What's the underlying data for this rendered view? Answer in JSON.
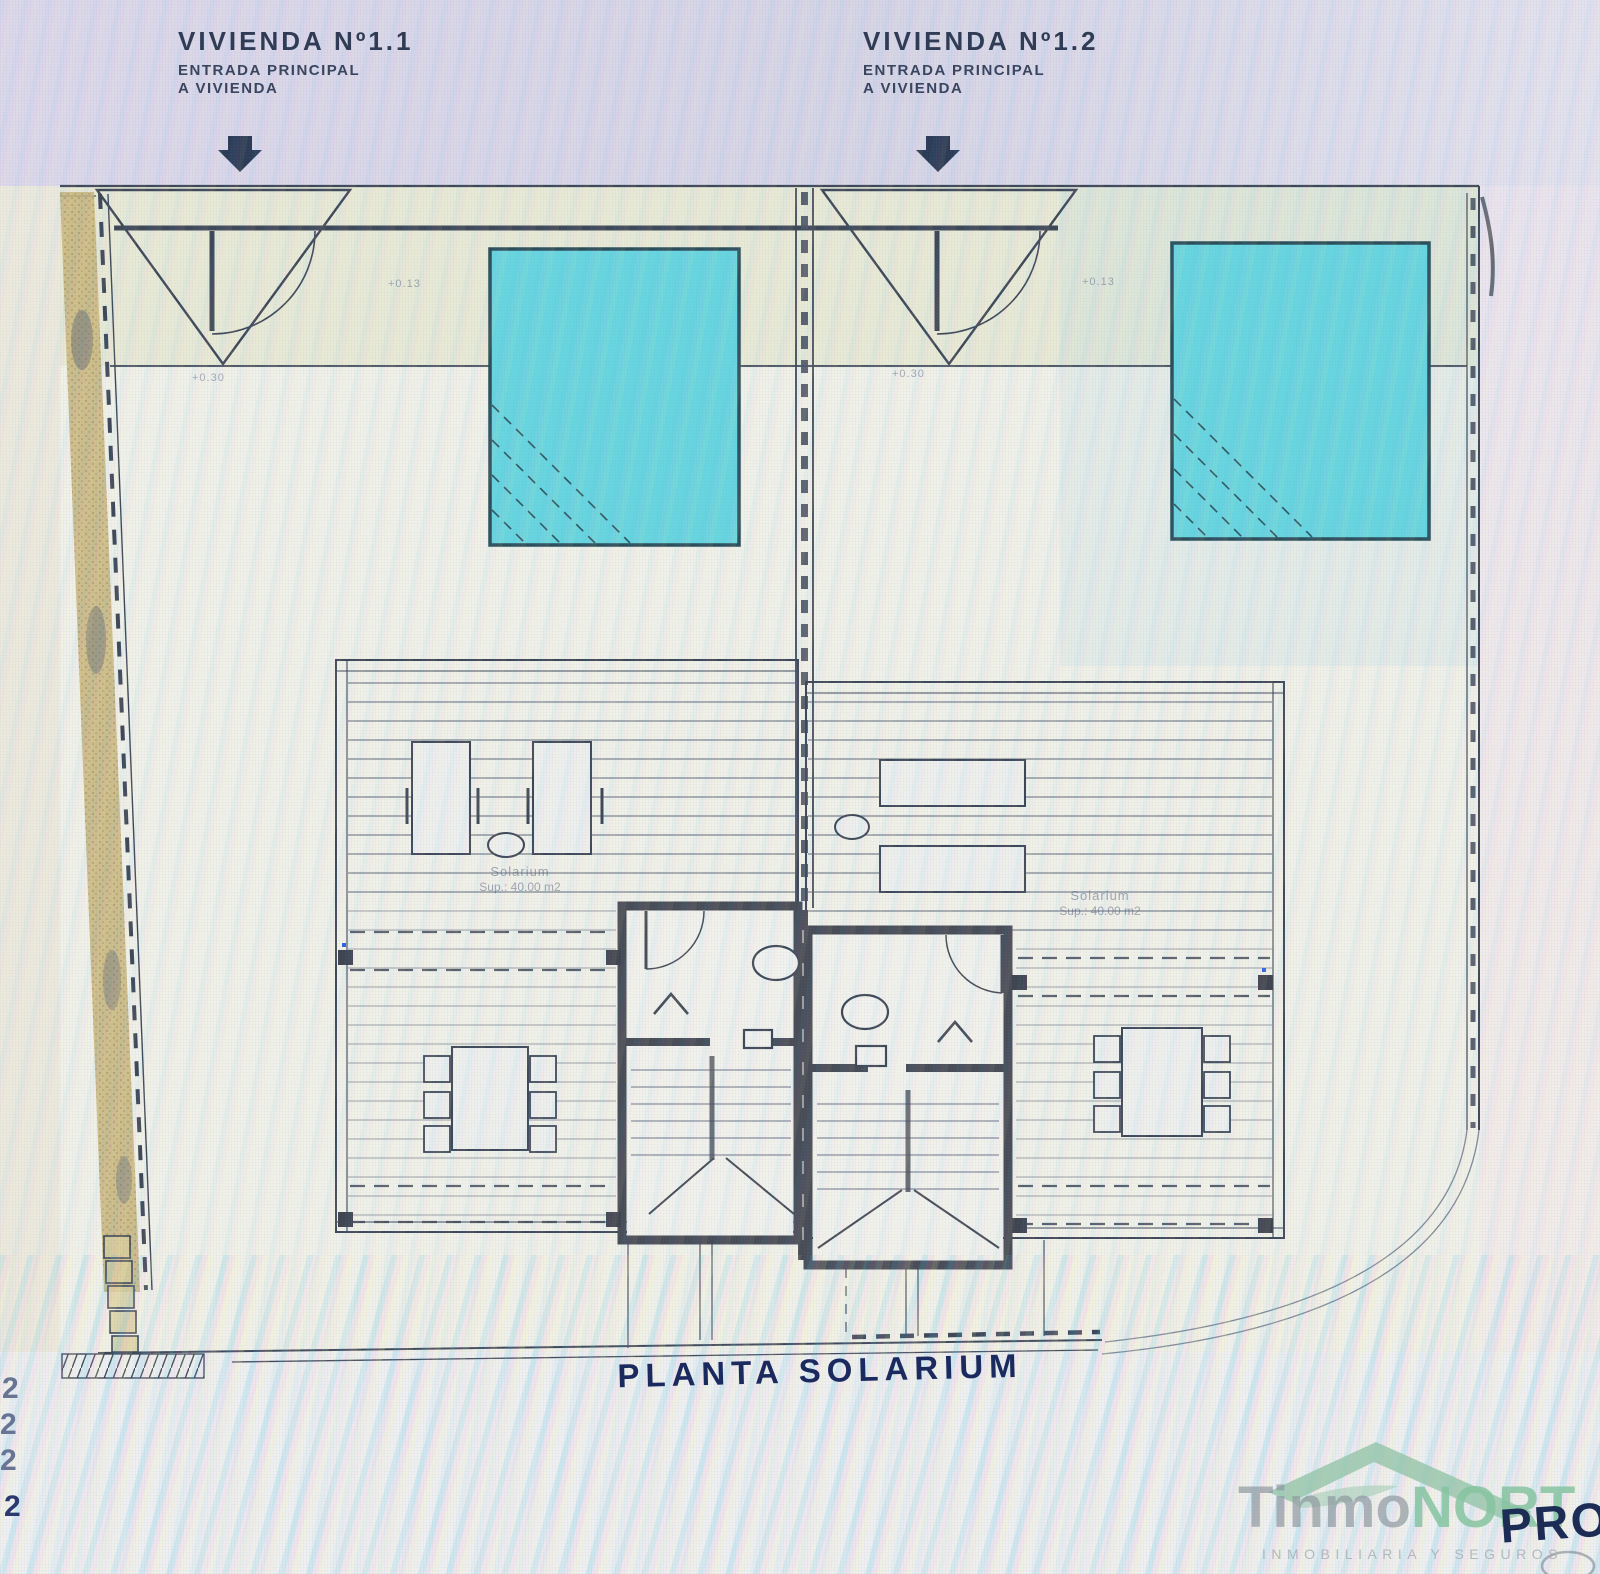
{
  "header": {
    "unit1": {
      "title": "VIVIENDA Nº1.1",
      "subtitle_line1": "ENTRADA PRINCIPAL",
      "subtitle_line2": "A VIVIENDA"
    },
    "unit2": {
      "title": "VIVIENDA Nº1.2",
      "subtitle_line1": "ENTRADA PRINCIPAL",
      "subtitle_line2": "A VIVIENDA"
    }
  },
  "plan": {
    "title": "PLANTA SOLARIUM",
    "level_marks": {
      "terrace_left": "+0.30",
      "terrace_right": "+0.30",
      "pool_left": "+0.13",
      "pool_right": "+0.13"
    },
    "solarium_left": {
      "name": "Solarium",
      "area": "Sup.: 40.00 m2"
    },
    "solarium_right": {
      "name": "Solarium",
      "area": "Sup.: 40.00 m2"
    }
  },
  "margin_fragments": [
    "2",
    "2",
    "2",
    "2"
  ],
  "watermark": {
    "brand_gray": "Tinmo",
    "brand_green": "NORT",
    "tagline": "INMOBILIARIA Y SEGUROS",
    "overlay_text": "PRO"
  },
  "colors": {
    "pool": "#68d6e0",
    "line": "#3d4757",
    "wall": "#474c57",
    "navy_text": "#1b2a5e",
    "brand_green": "#86c3a0",
    "brand_gray": "#8c969e"
  }
}
